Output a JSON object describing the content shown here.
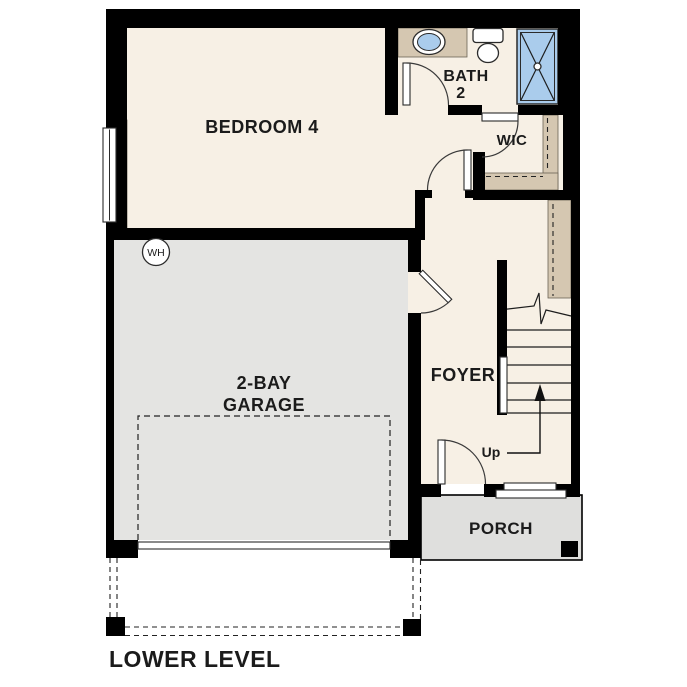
{
  "floor_plan": {
    "title": "LOWER LEVEL",
    "rooms": {
      "bedroom": "BEDROOM 4",
      "bath_line1": "BATH",
      "bath_line2": "2",
      "wic": "WIC",
      "garage_line1": "2-BAY",
      "garage_line2": "GARAGE",
      "foyer": "FOYER",
      "porch": "PORCH"
    },
    "annotations": {
      "water_heater": "WH",
      "stairs_up": "Up"
    },
    "colors": {
      "floor": "#f7f0e5",
      "garage_floor": "#e4e4e2",
      "porch": "#dfdfdd",
      "cabinetry": "#d5c7b1",
      "fixture_blue": "#aaccec",
      "wall": "#000000",
      "text": "#1b1b1b"
    }
  }
}
